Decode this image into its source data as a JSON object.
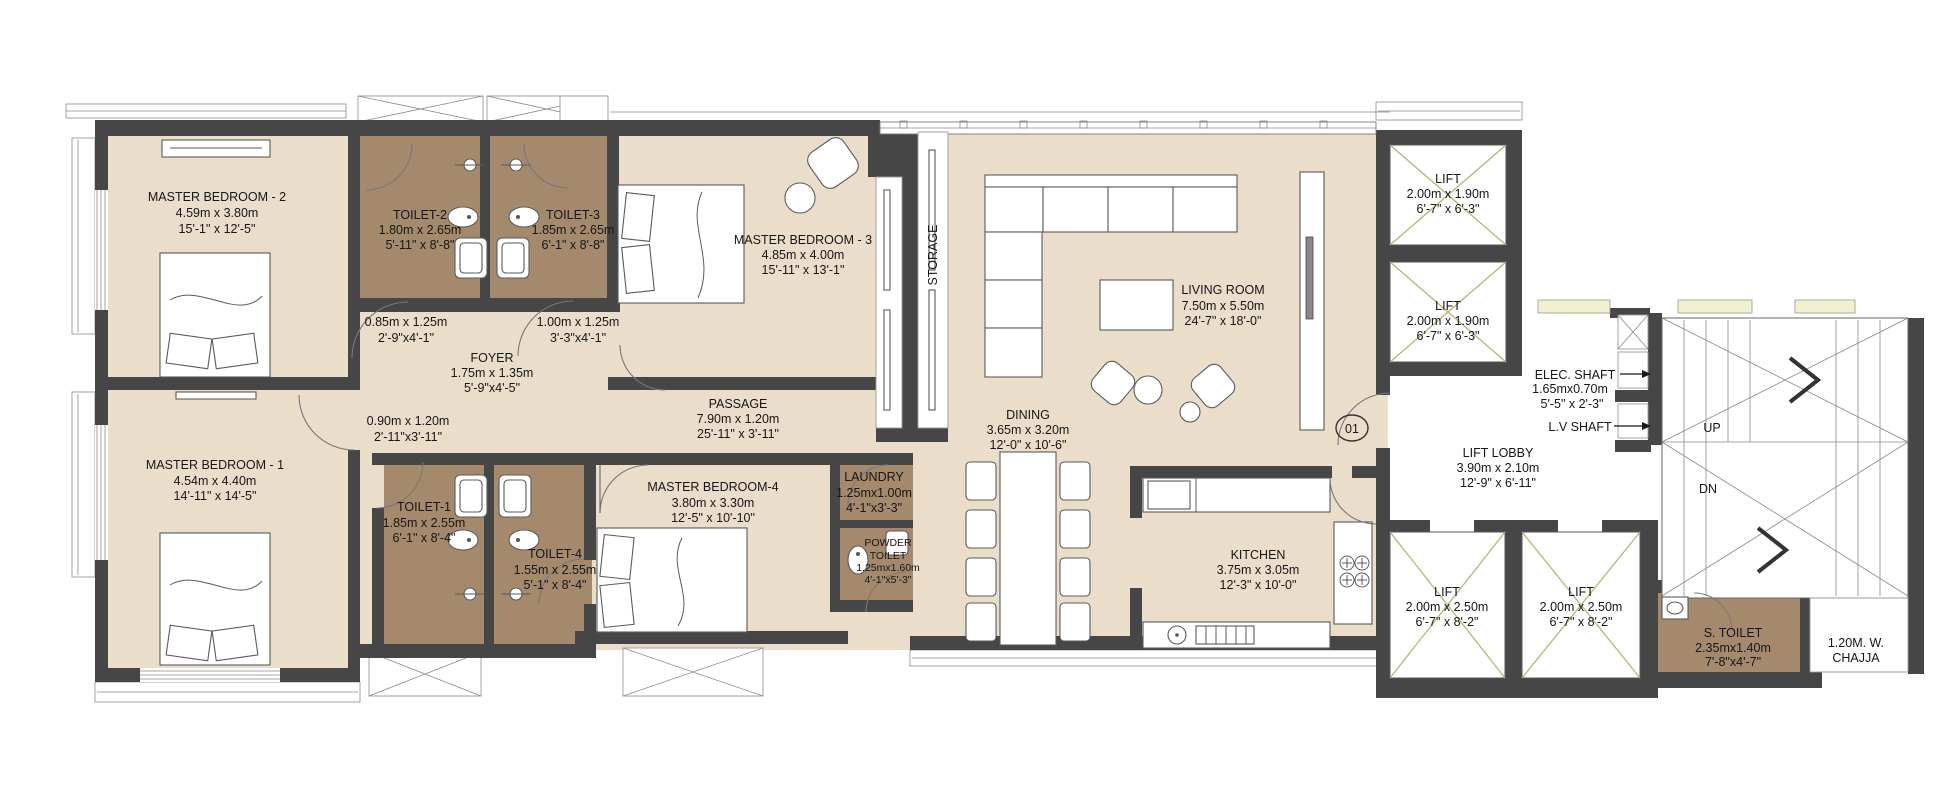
{
  "palette": {
    "floor_beige": "#eaddca",
    "toilet_brown": "#a5896c",
    "wall_dark": "#464646",
    "lift_cross_olive": "#b6b478",
    "planter_yellow": "#f1f0d0",
    "text": "#161616"
  },
  "rooms": {
    "master_bedroom_2": {
      "name": "MASTER BEDROOM - 2",
      "metric": "4.59m x 3.80m",
      "imperial": "15'-1\" x 12'-5\""
    },
    "toilet_2": {
      "name": "TOILET-2",
      "metric": "1.80m x 2.65m",
      "imperial": "5'-11\" x 8'-8\""
    },
    "toilet_3": {
      "name": "TOILET-3",
      "metric": "1.85m x 2.65m",
      "imperial": "6'-1\" x 8'-8\""
    },
    "master_bedroom_3": {
      "name": "MASTER BEDROOM - 3",
      "metric": "4.85m x 4.00m",
      "imperial": "15'-11\" x 13'-1\""
    },
    "storage": {
      "name": "STORAGE"
    },
    "living_room": {
      "name": "LIVING ROOM",
      "metric": "7.50m x 5.50m",
      "imperial": "24'-7\" x 18'-0\""
    },
    "foyer": {
      "name": "FOYER",
      "metric": "1.75m x 1.35m",
      "imperial": "5'-9\"x4'-5\""
    },
    "passage": {
      "name": "PASSAGE",
      "metric": "7.90m x 1.20m",
      "imperial": "25'-11\" x 3'-11\""
    },
    "master_bedroom_1": {
      "name": "MASTER BEDROOM - 1",
      "metric": "4.54m x 4.40m",
      "imperial": "14'-11\" x 14'-5\""
    },
    "toilet_1": {
      "name": "TOILET-1",
      "metric": "1.85m x 2.55m",
      "imperial": "6'-1\" x 8'-4\""
    },
    "toilet_4": {
      "name": "TOILET-4",
      "metric": "1.55m x 2.55m",
      "imperial": "5'-1\" x 8'-4\""
    },
    "master_bedroom_4": {
      "name": "MASTER BEDROOM-4",
      "metric": "3.80m x 3.30m",
      "imperial": "12'-5\" x 10'-10\""
    },
    "laundry": {
      "name": "LAUNDRY",
      "metric": "1.25mx1.00m",
      "imperial": "4'-1\"x3'-3\""
    },
    "powder_toilet": {
      "name_line1": "POWDER",
      "name_line2": "TOILET",
      "metric": "1.25mx1.60m",
      "imperial": "4'-1\"x5'-3\""
    },
    "dining": {
      "name": "DINING",
      "metric": "3.65m x 3.20m",
      "imperial": "12'-0\" x 10'-6\""
    },
    "kitchen": {
      "name": "KITCHEN",
      "metric": "3.75m x 3.05m",
      "imperial": "12'-3\" x 10'-0\""
    },
    "lift_top_1": {
      "name": "LIFT",
      "metric": "2.00m x 1.90m",
      "imperial": "6'-7\" x 6'-3\""
    },
    "lift_top_2": {
      "name": "LIFT",
      "metric": "2.00m x 1.90m",
      "imperial": "6'-7\" x 6'-3\""
    },
    "lift_bottom_1": {
      "name": "LIFT",
      "metric": "2.00m x 2.50m",
      "imperial": "6'-7\" x 8'-2\""
    },
    "lift_bottom_2": {
      "name": "LIFT",
      "metric": "2.00m x 2.50m",
      "imperial": "6'-7\" x 8'-2\""
    },
    "lift_lobby": {
      "name": "LIFT LOBBY",
      "metric": "3.90m x 2.10m",
      "imperial": "12'-9\" x 6'-11\""
    },
    "elec_shaft": {
      "name": "ELEC. SHAFT",
      "metric": "1.65mx0.70m",
      "imperial": "5'-5\" x 2'-3\""
    },
    "lv_shaft": {
      "name": "L.V SHAFT"
    },
    "servant_toilet": {
      "name": "S. TOILET",
      "metric": "2.35mx1.40m",
      "imperial": "7'-8\"x4'-7\""
    },
    "chajja": {
      "line1": "1.20M. W.",
      "line2": "CHAJJA"
    }
  },
  "annotations": {
    "window_1": {
      "metric": "0.85m x 1.25m",
      "imperial": "2'-9\"x4'-1\""
    },
    "window_2": {
      "metric": "1.00m x 1.25m",
      "imperial": "3'-3\"x4'-1\""
    },
    "door_1": {
      "metric": "0.90m x 1.20m",
      "imperial": "2'-11\"x3'-11\""
    },
    "stair_up": "UP",
    "stair_down": "DN",
    "unit_number": "01"
  }
}
